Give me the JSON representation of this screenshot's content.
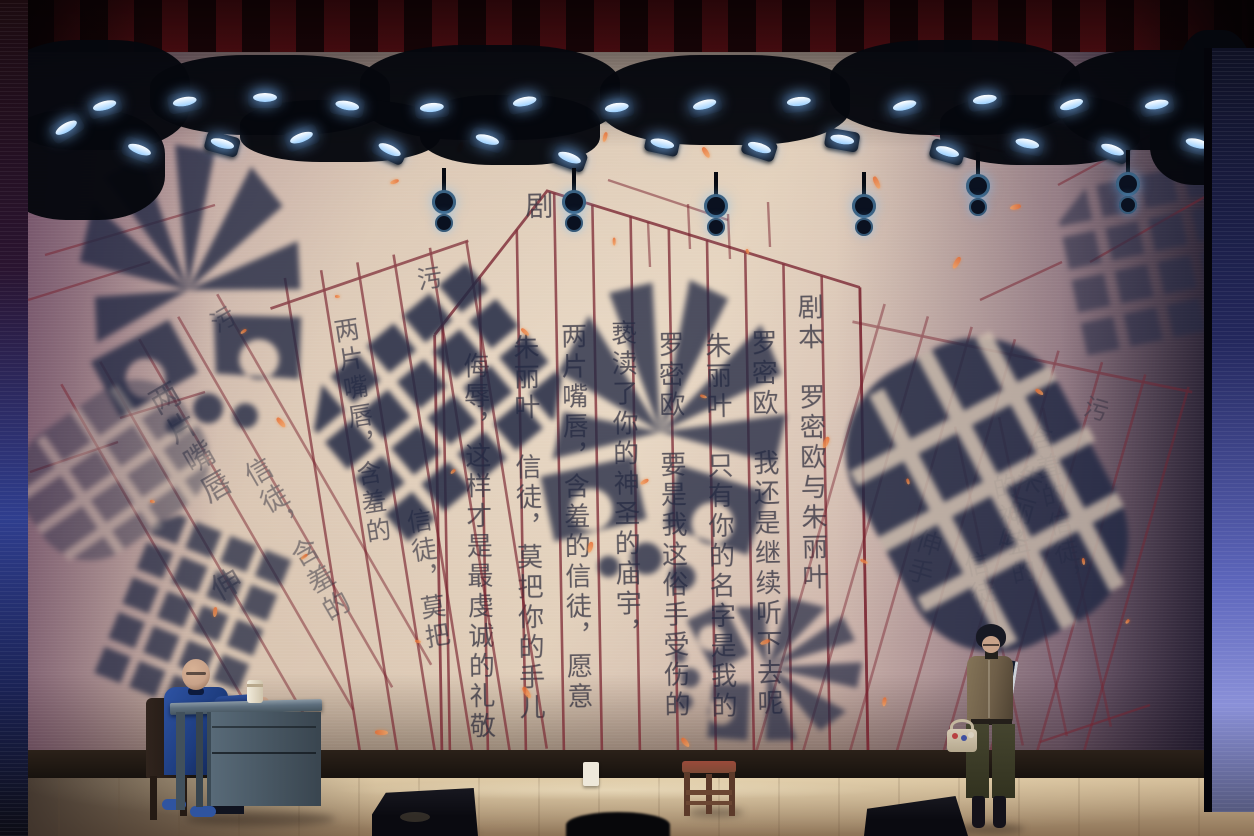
{
  "scene": {
    "backdrop_title": "剧本 罗密欧与朱丽叶"
  },
  "backdrop": {
    "title_char": "剧",
    "pages": {
      "center": {
        "columns": [
          "剧本　罗密欧与朱丽叶",
          "罗密欧　我还是继续听下去呢",
          "朱丽叶　只有你的名字是我的",
          "罗密欧　要是我这俗手受伤的",
          "亵渎了你的神圣的庙宇，",
          "两片嘴唇，含羞的信徒，愿意",
          "朱丽叶　信徒，莫把你的手儿",
          "侮辱，这样才是最虔诚的礼敬"
        ]
      },
      "left": {
        "columns": [
          "污",
          "两片嘴唇，含羞的",
          "信徒，莫把"
        ]
      },
      "far_left": {
        "columns": [
          "污",
          "两片嘴唇",
          "信徒，含羞的",
          "伸"
        ]
      },
      "right": {
        "columns": [
          "污",
          "朱丽叶",
          "伸手"
        ]
      },
      "mid_right": {
        "columns": [
          "含羞的信徒，",
          "的神圣的",
          "信徒"
        ]
      }
    }
  },
  "palette": {
    "paper": "#d8c3b0",
    "rule": "#78222f",
    "ink": "#262637",
    "print": "#222944",
    "fleck": "#e8682c",
    "curtain": "#3a0a0f",
    "truss": "#05070d",
    "lens_glow": "#9cd0ff",
    "floor_high": "#d3bc97",
    "floor_low": "#8d7357",
    "floor_dark": "#3a2f28",
    "band": "#120e0b",
    "side_left": "#2f3e8e",
    "side_right": "#5d66bc",
    "desk": "#5d6e7d",
    "desk_dark": "#39454f",
    "jacket": "#1d3c7e",
    "skin": "#c8a289",
    "chair_red_wood": "#7c4a36",
    "blouse": "#6e5e48",
    "trousers": "#45452f",
    "book": "#161e2e",
    "basket": "#d6cab4",
    "speaker": "#0a0a10"
  },
  "semantics": {
    "performers": [
      "seated actor in blue jacket at desk",
      "standing actress holding book and basket"
    ],
    "props": [
      "wooden desk",
      "mug",
      "dark chair",
      "red wooden chair",
      "monitor speakers",
      "white box",
      "basket"
    ],
    "backdrop_motifs": [
      "handwritten script pages",
      "boot print shadows",
      "orange ember flecks"
    ]
  }
}
